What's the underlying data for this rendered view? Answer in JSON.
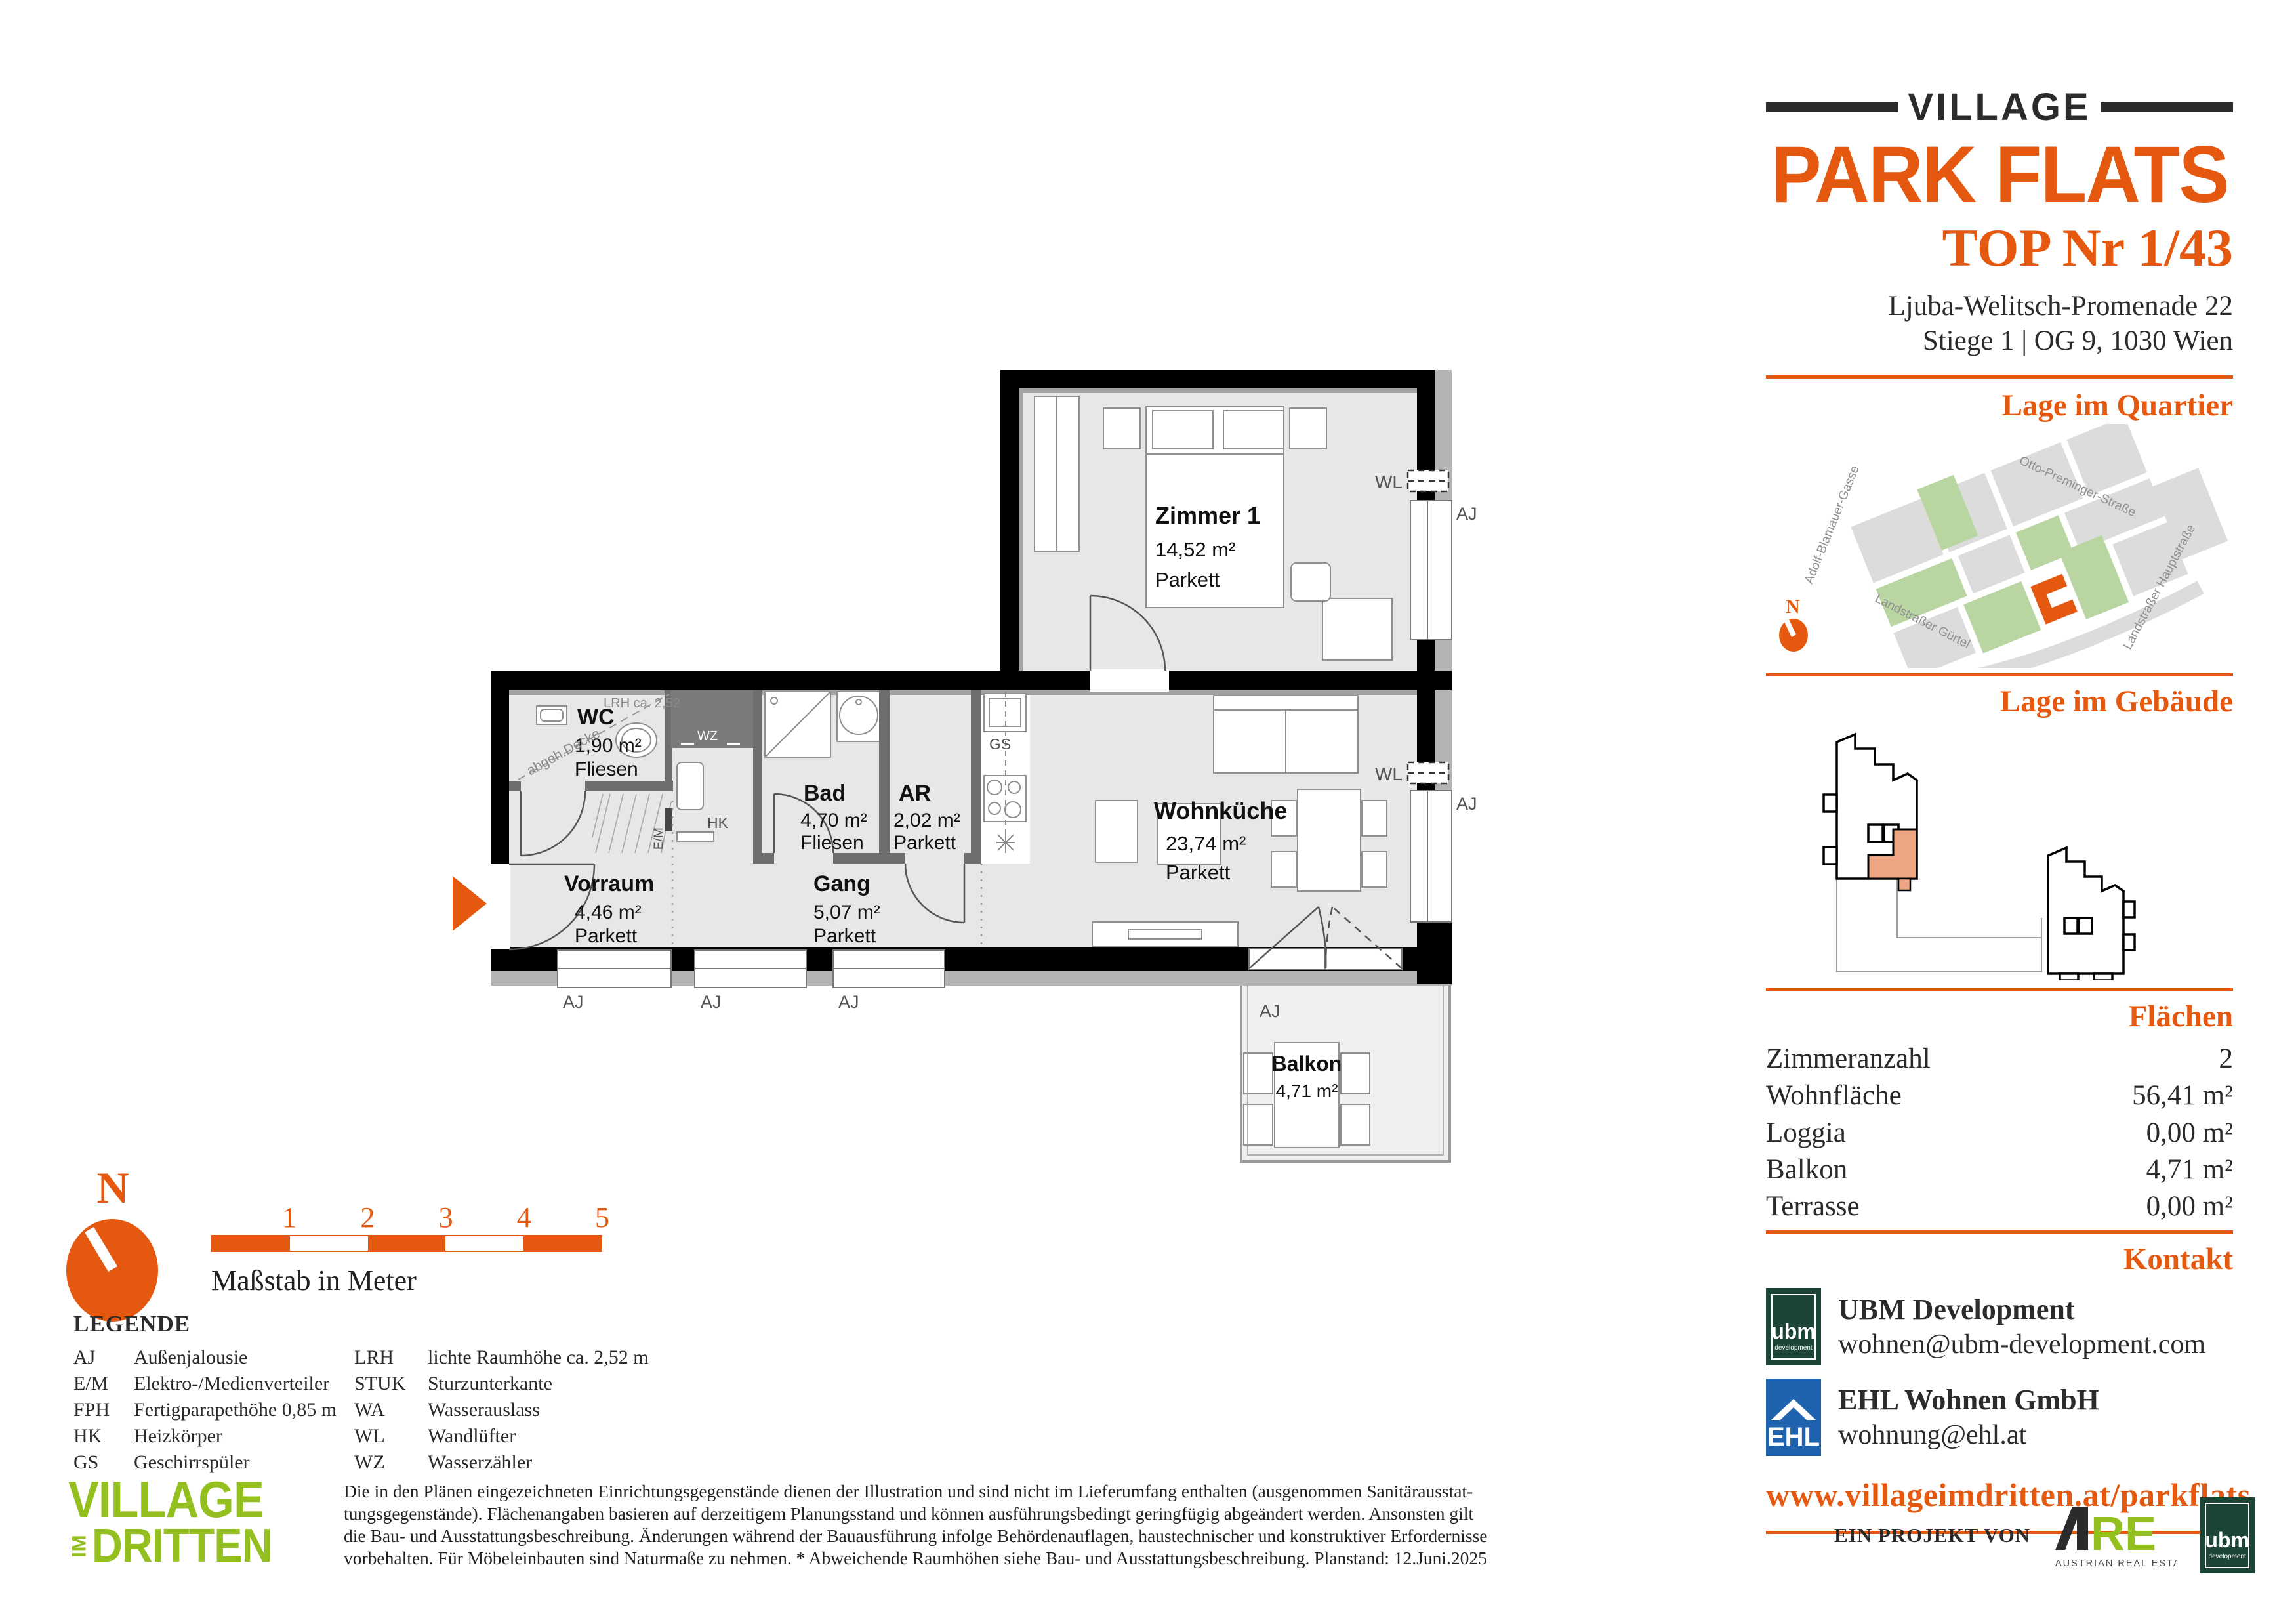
{
  "header": {
    "brand_top": "VILLAGE",
    "brand_main": "PARK FLATS",
    "unit": "TOP Nr 1/43",
    "address_line1": "Ljuba-Welitsch-Promenade 22",
    "address_line2": "Stiege 1 | OG 9, 1030 Wien"
  },
  "sections": {
    "quartier": "Lage im Quartier",
    "gebaeude": "Lage im Gebäude",
    "flaechen": "Flächen",
    "kontakt": "Kontakt"
  },
  "map": {
    "streets": [
      "Adolf-Blamauer-Gasse",
      "Otto-Preminger-Straße",
      "Landstraßer Gürtel",
      "Landstraßer Hauptstraße"
    ],
    "compass_n": "N"
  },
  "areas": {
    "rows": [
      {
        "label": "Zimmeranzahl",
        "value": "2"
      },
      {
        "label": "Wohnfläche",
        "value": "56,41 m²"
      },
      {
        "label": "Loggia",
        "value": "0,00 m²"
      },
      {
        "label": "Balkon",
        "value": "4,71 m²"
      },
      {
        "label": "Terrasse",
        "value": "0,00 m²"
      }
    ]
  },
  "kontakt": {
    "ubm_logo_word": "ubm",
    "ubm_logo_sub": "development",
    "ubm_name": "UBM Development",
    "ubm_email": "wohnen@ubm-development.com",
    "ehl_logo_word": "EHL",
    "ehl_name": "EHL Wohnen GmbH",
    "ehl_email": "wohnung@ehl.at",
    "url": "www.villageimdritten.at/parkflats"
  },
  "plan": {
    "rooms": {
      "zimmer1": {
        "name": "Zimmer 1",
        "area": "14,52 m²",
        "floor": "Parkett"
      },
      "wc": {
        "name": "WC",
        "area": "1,90 m²",
        "floor": "Fliesen"
      },
      "bad": {
        "name": "Bad",
        "area": "4,70 m²",
        "floor": "Fliesen"
      },
      "ar": {
        "name": "AR",
        "area": "2,02 m²",
        "floor": "Parkett"
      },
      "wohnkueche": {
        "name": "Wohnküche",
        "area": "23,74 m²",
        "floor": "Parkett"
      },
      "vorraum": {
        "name": "Vorraum",
        "area": "4,46 m²",
        "floor": "Parkett"
      },
      "gang": {
        "name": "Gang",
        "area": "5,07 m²",
        "floor": "Parkett"
      },
      "balkon": {
        "name": "Balkon",
        "area": "4,71 m²"
      }
    },
    "labels": {
      "aj": "AJ",
      "wl": "WL",
      "gs": "GS",
      "hk": "HK",
      "wz": "WZ",
      "em": "E/M",
      "lrh": "LRH ca. 2,52",
      "decke": "abgeh.Decke"
    }
  },
  "scalebar": {
    "ticks": [
      "1",
      "2",
      "3",
      "4",
      "5"
    ],
    "caption": "Maßstab in Meter",
    "compass_n": "N"
  },
  "legend": {
    "title": "LEGENDE",
    "col1": [
      {
        "abbr": "AJ",
        "label": "Außenjalousie"
      },
      {
        "abbr": "E/M",
        "label": "Elektro-/Medienverteiler"
      },
      {
        "abbr": "FPH",
        "label": "Fertigparapethöhe 0,85 m"
      },
      {
        "abbr": "HK",
        "label": "Heizkörper"
      },
      {
        "abbr": "GS",
        "label": "Geschirrspüler"
      }
    ],
    "col2": [
      {
        "abbr": "LRH",
        "label": "lichte Raumhöhe ca. 2,52 m"
      },
      {
        "abbr": "STUK",
        "label": "Sturzunterkante"
      },
      {
        "abbr": "WA",
        "label": "Wasserauslass"
      },
      {
        "abbr": "WL",
        "label": "Wandlüfter"
      },
      {
        "abbr": "WZ",
        "label": "Wasserzähler"
      }
    ]
  },
  "disclaimer_lines": [
    "Die in den Plänen eingezeichneten Einrichtungsgegenstände dienen der Illustration und sind nicht im Lieferumfang enthalten (ausgenommen Sanitärausstat-",
    "tungsgegenstände). Flächenangaben basieren auf derzeitigem Planungsstand und können ausführungsbedingt geringfügig abgeändert werden. Ansonsten gilt",
    "die Bau- und Ausstattungsbeschreibung. Änderungen während der Bauausführung infolge Behördenauflagen, haustechnischer und konstruktiver Erfordernisse",
    "vorbehalten. Für Möbeleinbauten sind Naturmaße zu nehmen. * Abweichende Raumhöhen siehe Bau- und Ausstattungsbeschreibung. Planstand: 12.Juni.2025"
  ],
  "village_logo": {
    "line1": "VILLAGE",
    "im": "IM",
    "line2": "DRITTEN"
  },
  "project": {
    "prefix": "EIN PROJEKT VON",
    "are_re": "RE",
    "are_sub": "AUSTRIAN REAL ESTATE",
    "ubm_word": "ubm",
    "ubm_sub": "development"
  },
  "colors": {
    "accent": "#E4590F",
    "logo_green": "#93C01F",
    "ubm_green": "#1C4536",
    "ehl_blue": "#1F62AD",
    "unit_salmon": "#EDA583"
  }
}
